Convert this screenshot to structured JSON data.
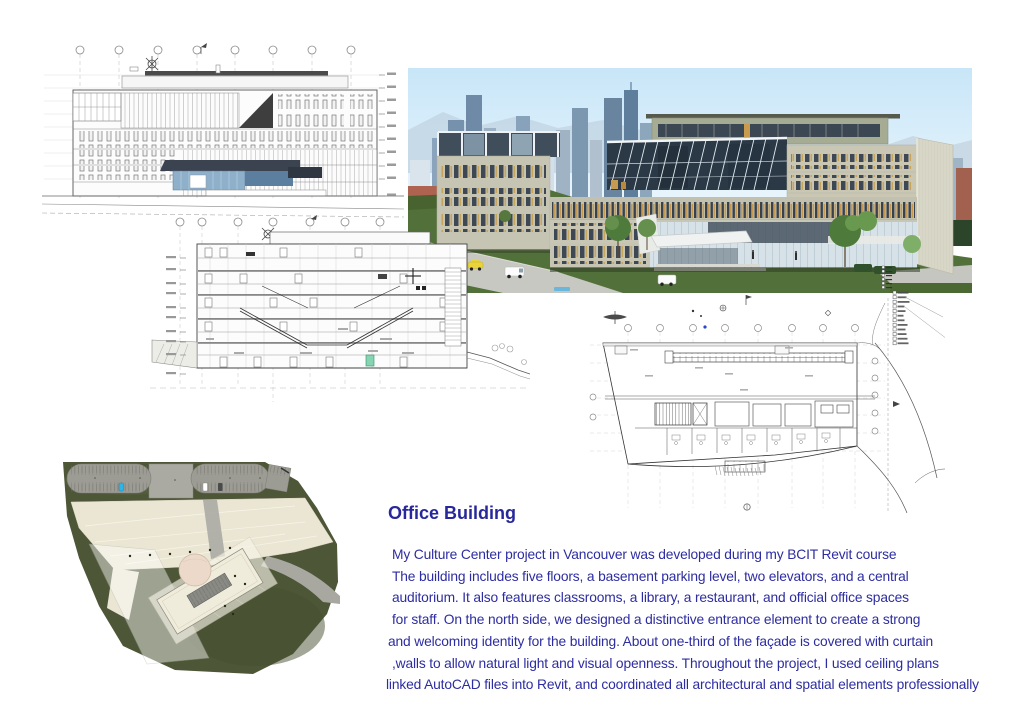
{
  "page": {
    "width": 1024,
    "height": 724,
    "background": "#ffffff"
  },
  "header": {
    "title": "Office Building",
    "title_color": "#28289b"
  },
  "description": {
    "text_color": "#2d2da2",
    "lines": [
      "My Culture Center project in Vancouver was developed during my BCIT Revit course",
      "The building includes five floors, a basement parking level, two elevators, and a central",
      "auditorium. It also features classrooms, a library, a restaurant, and official office spaces",
      "for staff. On the north side, we designed a distinctive entrance element to create a strong",
      "and welcoming identity for the building. About one-third of the façade is covered with curtain",
      ",walls to allow natural light and visual openness. Throughout the project, I used ceiling plans",
      "linked AutoCAD files into Revit, and coordinated all architectural and spatial elements professionally"
    ]
  },
  "figures": {
    "elevation": {
      "name": "north-elevation-cad-drawing"
    },
    "render": {
      "name": "exterior-3d-render"
    },
    "section": {
      "name": "building-section-cad-drawing"
    },
    "floor_plan": {
      "name": "floor-plan-cad-drawing"
    },
    "site_plan": {
      "name": "site-plan-rendered"
    }
  },
  "palette": {
    "navy": "#28289b",
    "cad_line": "#555555",
    "sky": "#cfe9f8",
    "grass": "#55703c",
    "facade": "#c9c7b4",
    "glass_dark": "#2b3845",
    "accent_amber": "#c59a50",
    "site_olive": "#4d5637",
    "site_cream": "#eae6d3",
    "parking_grey": "#9c9c93",
    "dome_pink": "#ecd9c9",
    "entrance_blue": "#8fb0ca"
  }
}
